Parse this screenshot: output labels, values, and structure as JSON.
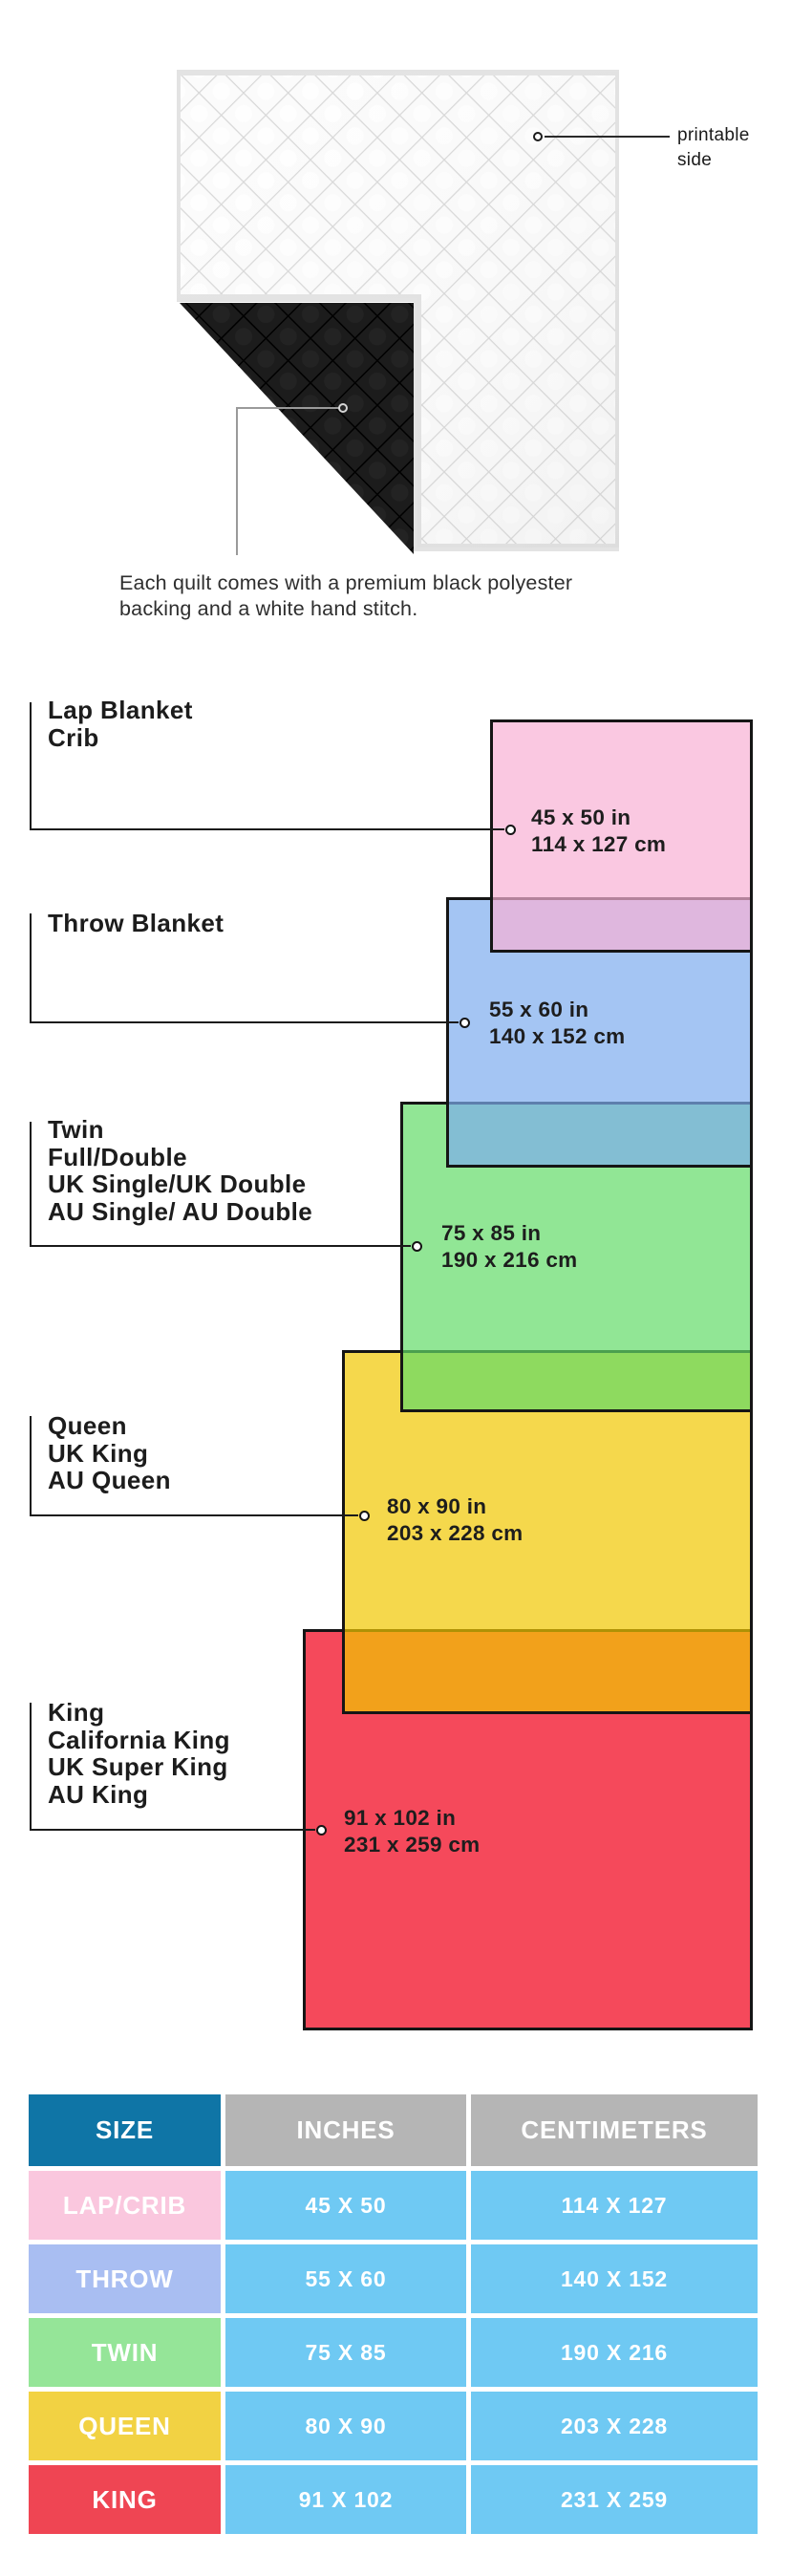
{
  "hero": {
    "printable_side_lines": [
      "printable",
      "side"
    ],
    "caption_lines": [
      "Each quilt comes with a premium black polyester",
      "backing and a white hand stitch."
    ]
  },
  "diagram": {
    "items": [
      {
        "id": "lap",
        "name_lines": [
          "Lap Blanket",
          "Crib"
        ],
        "inches": "45 x 50 in",
        "centimeters": "114 x 127 cm",
        "fill": "rgba(248,176,212,0.7)"
      },
      {
        "id": "throw",
        "name_lines": [
          "Throw Blanket"
        ],
        "inches": "55 x 60 in",
        "centimeters": "140 x 152 cm",
        "fill": "rgba(125,172,238,0.7)"
      },
      {
        "id": "twin",
        "name_lines": [
          "Twin",
          "Full/Double",
          "UK Single/UK Double",
          "AU Single/ AU Double"
        ],
        "inches": "75 x 85 in",
        "centimeters": "190 x 216 cm",
        "fill": "rgba(99,219,104,0.7)"
      },
      {
        "id": "queen",
        "name_lines": [
          "Queen",
          "UK King",
          "AU Queen"
        ],
        "inches": "80 x 90 in",
        "centimeters": "203 x 228 cm",
        "fill": "rgba(241,199,0,0.7)"
      },
      {
        "id": "king",
        "name_lines": [
          "King",
          "California King",
          "UK Super King",
          "AU King"
        ],
        "inches": "91 x 102 in",
        "centimeters": "231 x 259 cm",
        "fill": "#F5495B"
      }
    ]
  },
  "table": {
    "headers": [
      "SIZE",
      "INCHES",
      "CENTIMETERS"
    ],
    "size_header_color": "#0F75A6",
    "measure_header_color": "#B5B5B5",
    "value_cell_color": "#6FC9F3",
    "rows": [
      {
        "size": "LAP/CRIB",
        "inches": "45 X 50",
        "centimeters": "114 X 127",
        "color": "#FAC7DE"
      },
      {
        "size": "THROW",
        "inches": "55 X 60",
        "centimeters": "140 X 152",
        "color": "#A9BEF2"
      },
      {
        "size": "TWIN",
        "inches": "75 X 85",
        "centimeters": "190 X 216",
        "color": "#95E598"
      },
      {
        "size": "QUEEN",
        "inches": "80 X 90",
        "centimeters": "203 X 228",
        "color": "#F2D243"
      },
      {
        "size": "KING",
        "inches": "91 X 102",
        "centimeters": "231 X 259",
        "color": "#EF4553"
      }
    ]
  }
}
